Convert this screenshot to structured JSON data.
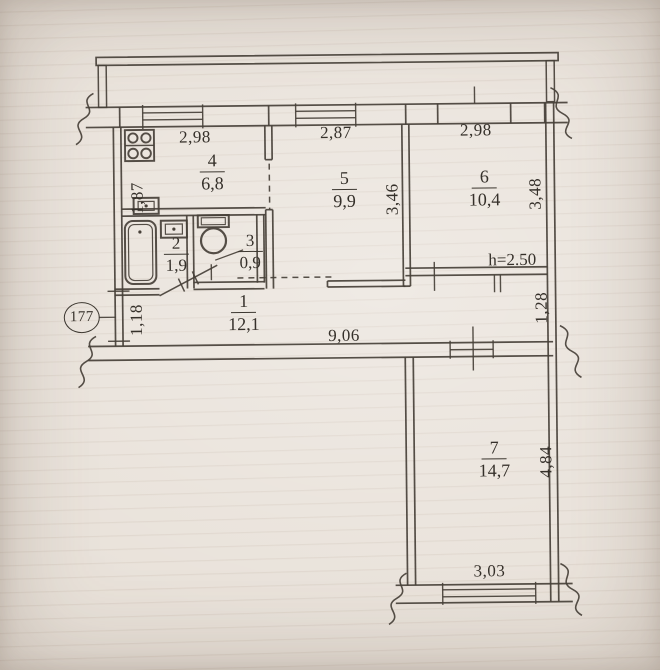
{
  "plan": {
    "apartment_circle": "177",
    "ceiling_height": "h=2.50",
    "rooms": {
      "r1": {
        "number": "1",
        "area": "12,1"
      },
      "r2": {
        "number": "2",
        "area": "1,9"
      },
      "r3": {
        "number": "3",
        "area": "0,9"
      },
      "r4": {
        "number": "4",
        "area": "6,8"
      },
      "r5": {
        "number": "5",
        "area": "9,9"
      },
      "r6": {
        "number": "6",
        "area": "10,4"
      },
      "r7": {
        "number": "7",
        "area": "14,7"
      }
    },
    "dims": {
      "top_left": "2,98",
      "top_mid": "2,87",
      "top_right": "2,98",
      "kitchen_left": "1,87",
      "hall_left": "1,18",
      "hall_width": "9,06",
      "hall_right": "1,28",
      "room5_depth": "3,46",
      "room6_depth": "3,48",
      "room7_depth": "4,84",
      "room7_width": "3,03"
    },
    "icons": {
      "stove": "stove-icon",
      "kitchen_sink": "sink-icon",
      "bathroom_sink": "sink-icon",
      "bathtub": "bathtub-icon",
      "toilet": "toilet-icon",
      "wall_break": "wall-break-icon"
    },
    "colors": {
      "paper": "#e9e2da",
      "ink": "#474038"
    }
  }
}
